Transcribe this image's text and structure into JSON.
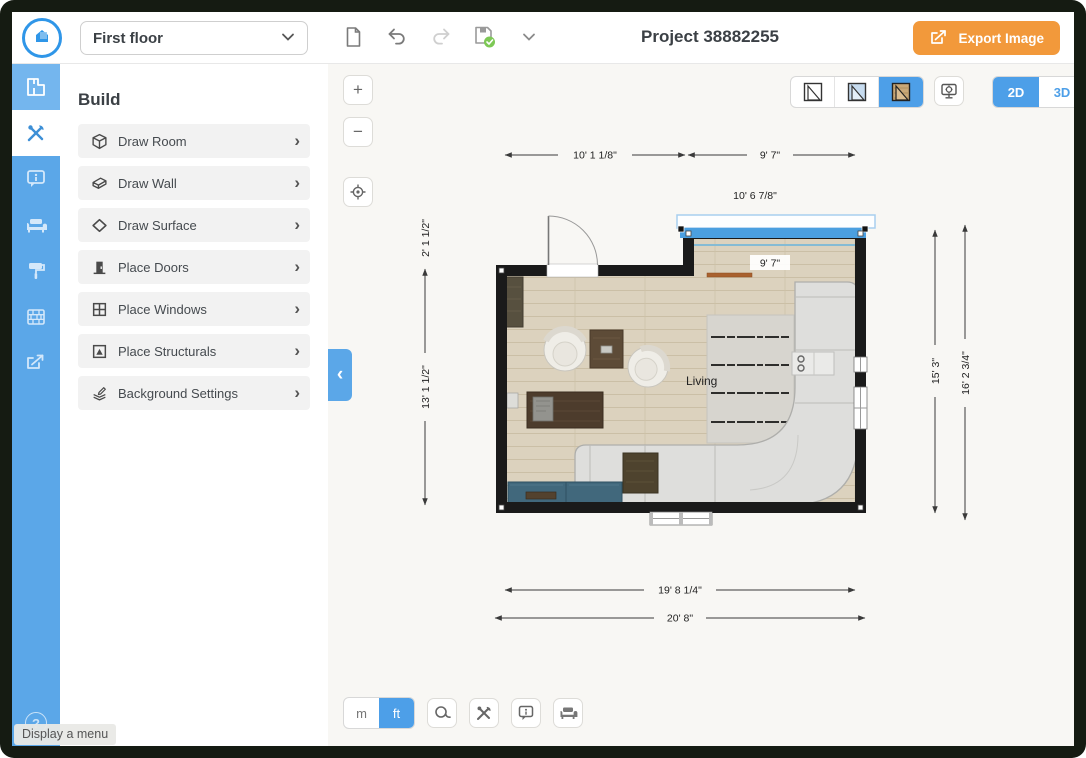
{
  "topbar": {
    "floor_selector_value": "First floor",
    "project_title": "Project 38882255",
    "export_button_label": "Export Image"
  },
  "sidebar": {
    "tooltip": "Display a menu",
    "help_glyph": "?"
  },
  "build_panel": {
    "title": "Build",
    "items": [
      {
        "label": "Draw Room"
      },
      {
        "label": "Draw Wall"
      },
      {
        "label": "Draw Surface"
      },
      {
        "label": "Place Doors"
      },
      {
        "label": "Place Windows"
      },
      {
        "label": "Place Structurals"
      },
      {
        "label": "Background Settings"
      }
    ]
  },
  "icons": {
    "chevron_right": "›",
    "chevron_left": "‹",
    "plus": "+",
    "minus": "−"
  },
  "canvas": {
    "view_modes": {
      "mode_2d": "2D",
      "mode_3d": "3D",
      "selected": "2D"
    },
    "units": {
      "metric": "m",
      "imperial": "ft",
      "selected": "ft"
    }
  },
  "floorplan": {
    "room_label": "Living",
    "dims": {
      "top_left_width": "10' 1 1/8\"",
      "top_right_width": "9' 7\"",
      "window_width": "10' 6 7/8\"",
      "interior_width": "9' 7\"",
      "left_step_height": "2' 1 1/2\"",
      "left_height": "13' 1 1/2\"",
      "right_inner_height": "15' 3\"",
      "right_outer_height": "16' 2 3/4\"",
      "bottom_inner_width": "19' 8 1/4\"",
      "bottom_outer_width": "20' 8\""
    }
  },
  "colors": {
    "accent_blue": "#4D9FE8",
    "sidebar_blue": "#5BA7E8",
    "export_orange": "#F2993B",
    "selection_blue": "#4B9FE0",
    "save_check_green": "#7DC855",
    "wall_black": "#1A1A1A",
    "floor_wood": "#DCD2BE"
  }
}
